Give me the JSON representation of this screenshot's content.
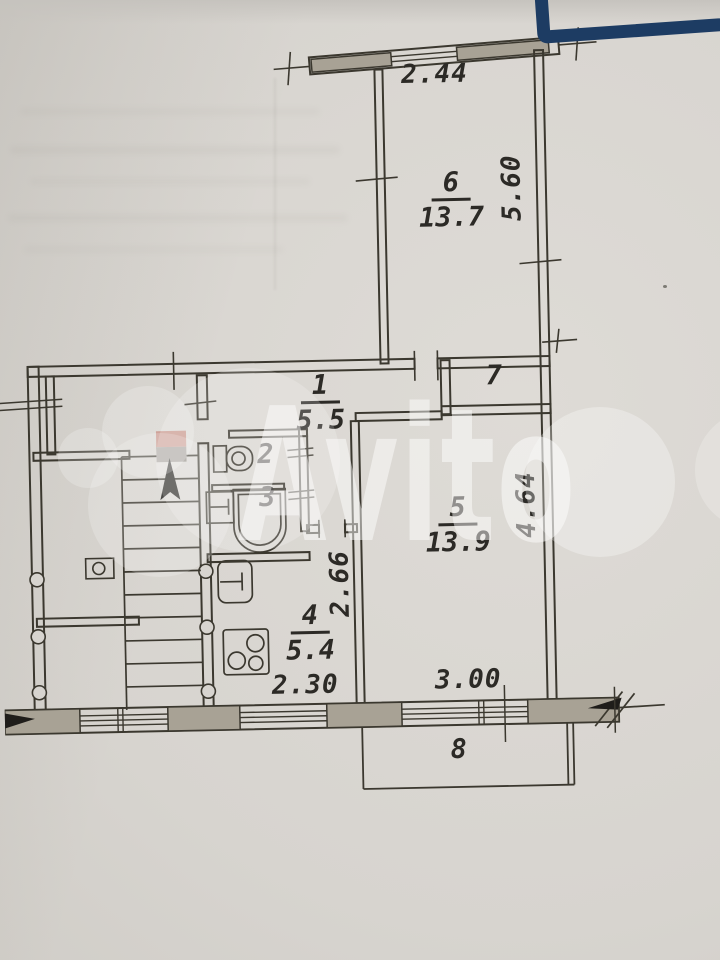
{
  "photo": {
    "type": "scanned apartment floor plan"
  },
  "watermark": {
    "text": "Avito"
  },
  "rooms": [
    {
      "id": "room-6",
      "number": "6",
      "area": "13.7"
    },
    {
      "id": "room-7",
      "number": "7",
      "area": ""
    },
    {
      "id": "room-1",
      "number": "1",
      "area": "5.5"
    },
    {
      "id": "room-2",
      "number": "2",
      "area": ""
    },
    {
      "id": "room-3",
      "number": "3",
      "area": ""
    },
    {
      "id": "room-5",
      "number": "5",
      "area": "13.9"
    },
    {
      "id": "room-4",
      "number": "4",
      "area": "5.4"
    },
    {
      "id": "room-8",
      "number": "8",
      "area": ""
    }
  ],
  "dimensions": [
    {
      "id": "balcony-width",
      "value": "2.44",
      "orientation": "horizontal"
    },
    {
      "id": "room6-depth",
      "value": "5.60",
      "orientation": "vertical"
    },
    {
      "id": "room5-depth",
      "value": "4.64",
      "orientation": "vertical"
    },
    {
      "id": "kitchen-depth",
      "value": "2.66",
      "orientation": "vertical"
    },
    {
      "id": "kitchen-width",
      "value": "2.30",
      "orientation": "horizontal"
    },
    {
      "id": "room5-width",
      "value": "3.00",
      "orientation": "horizontal"
    }
  ],
  "colors": {
    "paper": "#d7d4cf",
    "ink": "#3b382f",
    "wall_fill": "#a8a295",
    "marker_pink": "#c28a7e",
    "marker_gray": "#948f88",
    "frame_blue": "#1d3c63",
    "watermark": "#ffffff"
  }
}
